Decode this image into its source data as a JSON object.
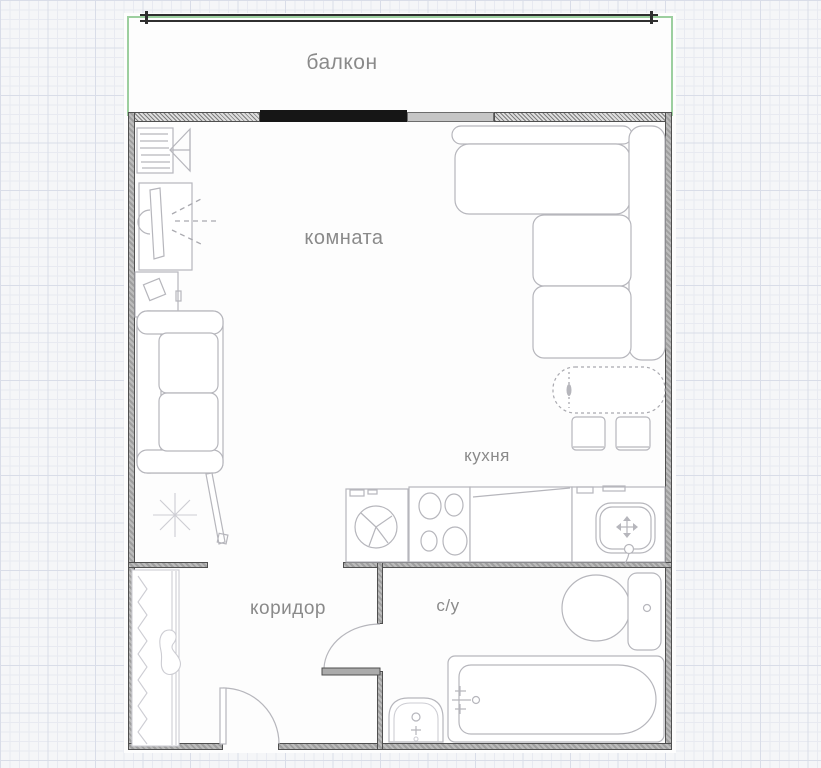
{
  "floor_plan": {
    "labels": {
      "balcony": "балкон",
      "room": "комната",
      "kitchen": "кухня",
      "corridor": "коридор",
      "bathroom": "с/у"
    },
    "colors": {
      "balcony_outline": "#9ccf9f",
      "wall_fill": "#ababab",
      "wall_edge": "#4f4f4f",
      "window_solid": "#161616",
      "furniture_line": "#b6b6bc",
      "label_text": "#8a8a8a",
      "grid_minor": "#e8eaf1",
      "grid_major": "#d9dde8"
    }
  }
}
